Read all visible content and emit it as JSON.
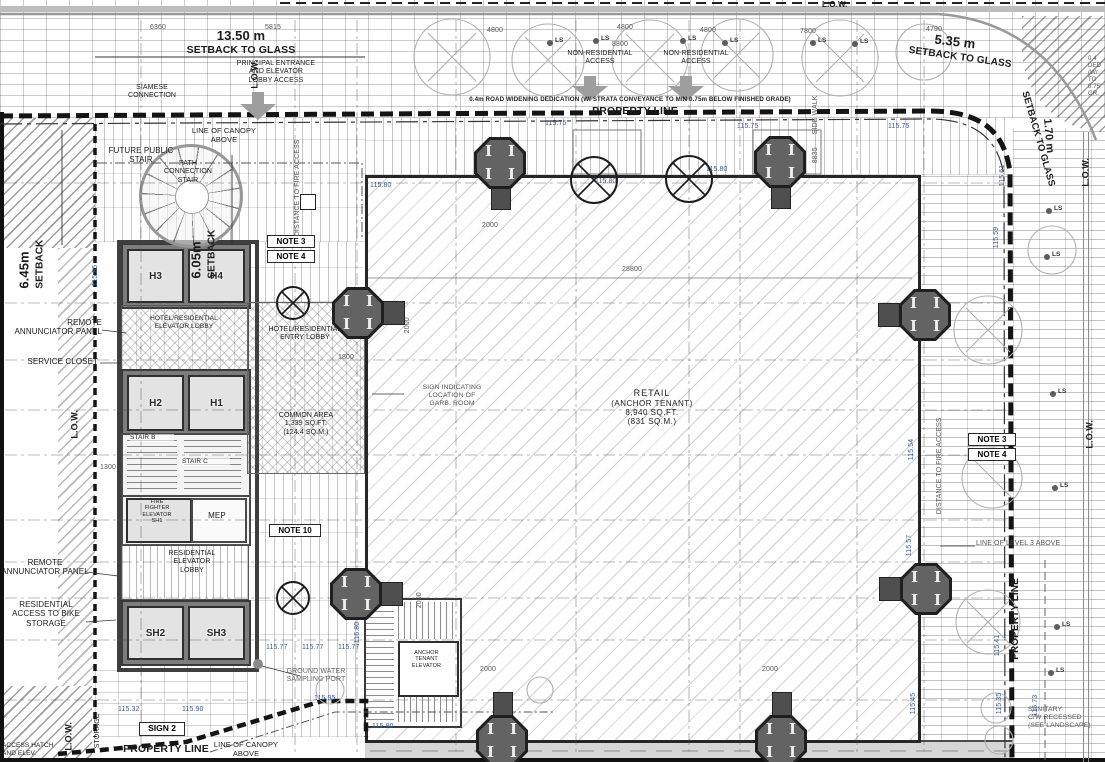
{
  "setbacks": {
    "top_left_value": "13.50 m",
    "top_left_label": "SETBACK TO GLASS",
    "top_right_value": "5.35 m",
    "top_right_label": "SETBACK TO GLASS",
    "left_upper_value": "6.45m",
    "left_upper_label": "SETBACK",
    "left_inner_value": "6.05m",
    "left_inner_label": "SETBACK",
    "right_value": "1.70 m",
    "right_label": "SETBACK TO GLASS"
  },
  "property_lines": {
    "top": "PROPERTY LINE",
    "bottom": "PROPERTY LINE",
    "right": "PROPERTY LINE",
    "road_widening": "0.4m ROAD WIDENING DEDICATION (W/ STRATA CONVEYANCE TO MIN 0.75m BELOW FINISHED GRADE)",
    "road_widening_right": "0.4\nDED\n(W/\nTO\n0.75\nGR.",
    "low": "L.O.W."
  },
  "access": {
    "principal": "PRINCIPAL ENTRANCE\nAND ELEVATOR\nLOBBY ACCESS",
    "non_residential": "NON-RESIDENTIAL\nACCESS",
    "siamese": "SIAMESE\nCONNECTION",
    "future_stair": "FUTURE PUBLIC\nSTAIR",
    "path_stair": "PATH\nCONNECTION\nSTAIR",
    "canopy": "LINE OF CANOPY\nABOVE",
    "fire_distance": "DISTANCE TO FIRE ACCESS",
    "level3": "LINE OF LEVEL 3 ABOVE",
    "sidewalk": "SIDE WALK"
  },
  "retail": {
    "name": "RETAIL",
    "tenant": "(ANCHOR TENANT)",
    "area_ft": "8,940 SQ.FT.",
    "area_m": "(831 SQ.M.)",
    "sign_note": "SIGN INDICATING\nLOCATION OF\nGARB. ROOM"
  },
  "core": {
    "elevator_lobby": "HOTEL/RESIDENTIAL\nELEVATOR LOBBY",
    "entry_lobby": "HOTEL/RESIDENTIAL\nENTRY LOBBY",
    "common_area": "COMMON AREA\n1,339 SQ.FT.\n(124.4 SQ.M.)",
    "res_elev_lobby": "RESIDENTIAL\nELEVATOR\nLOBBY",
    "stair_b": "STAIR B",
    "stair_c": "STAIR C",
    "ff_elevator": "FIRE\nFIGHTER\nELEVATOR\nSH1",
    "mep": "MEP",
    "anchor_elevator": "ANCHOR\nTENANT\nELEVATOR",
    "h1": "H1",
    "h2": "H2",
    "h3": "H3",
    "h4": "H4",
    "sh2": "SH2",
    "sh3": "SH3"
  },
  "notes": {
    "note3": "NOTE 3",
    "note4": "NOTE 4",
    "note10": "NOTE 10"
  },
  "side_labels": {
    "remote_panel": "REMOTE\nANNUNCIATOR PANEL",
    "service_closet": "SERVICE CLOSET",
    "bike": "RESIDENTIAL\nACCESS TO BIKE\nSTORAGE",
    "storage": "STORAGE",
    "hatch": "ACCESS HATCH\nAND ELEV.",
    "groundwater": "GROUND WATER\nSAMPLING PORT",
    "sign2": "SIGN 2",
    "sanitary": "SANITARY\nC/W RECESSED\n(SEE LANDSCAPE)"
  },
  "markers": {
    "ls": "LS"
  },
  "dim_labels": [
    "6360",
    "5815",
    "4800",
    "4800",
    "4800",
    "7800",
    "4790",
    "8800",
    "28800",
    "2000",
    "2000",
    "2000",
    "2000",
    "2000",
    "1800",
    "1300",
    "8835"
  ],
  "elevations": [
    "115.75",
    "115.75",
    "115.75",
    "115.80",
    "115.80",
    "115.80",
    "115.85",
    "115.80",
    "115.77",
    "115.77",
    "115.77",
    "115.90",
    "115.32",
    "115.95",
    "115.80",
    "115.61",
    "115.59",
    "115.54",
    "115.57",
    "115.45",
    "115.41",
    "115.35",
    "115.73"
  ],
  "colors": {
    "wall": "#2e2e2e",
    "column": "#636363",
    "arrow": "#9e9e9e",
    "elevation_text": "#3c5c91"
  }
}
